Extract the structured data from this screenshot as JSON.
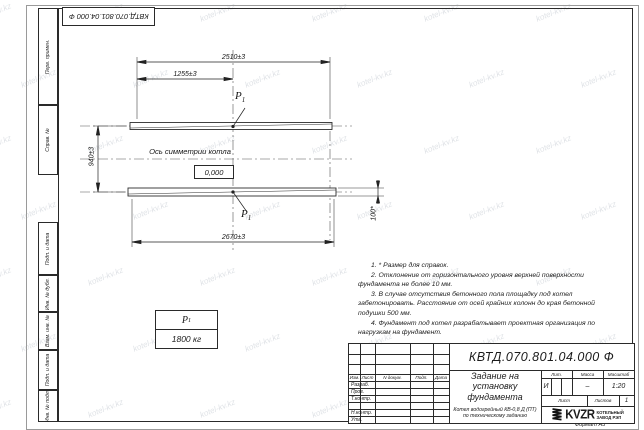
{
  "watermark": {
    "text": "kotel-kv.kz"
  },
  "doc_box": {
    "number": "КВТД.070.801.04.000 Ф"
  },
  "stamp_column": {
    "items": [
      "Перв. примен.",
      "Справ. №",
      "Подп. и дата",
      "Инв. № дубл.",
      "Взам. инв. №",
      "Подп. и дата",
      "Инв. № подл."
    ]
  },
  "drawing": {
    "dims": {
      "top": "2510±3",
      "half": "1255±3",
      "vertical": "940±3",
      "bottom": "2670±3",
      "height": "100*"
    },
    "axis_label": "Ось симметрии котла",
    "level_mark": "0,000",
    "load_label": {
      "base": "P",
      "sub": "1"
    },
    "load_table": {
      "header_base": "P",
      "header_sub": "1",
      "value": "1800 кг"
    }
  },
  "notes": [
    "1. * Размер для справок.",
    "2. Отклонение от горизонтального уровня верхней поверхности фундамента не более 10 мм.",
    "3. В случае отсутствия бетонного пола площадку под котел забетонировать. Расстояние от осей крайних колонн до края бетонной подушки 500 мм.",
    "4. Фундамент под котел разрабатывает проектная организация по нагрузкам на фундамент."
  ],
  "title_block": {
    "doc_number": "КВТД.070.801.04.000 Ф",
    "title": "Задание на установку фундамента",
    "subject": "Котел водогрейный КВ-0,8 Д (ПТ) по техническому заданию",
    "header_cols": [
      "Изм.",
      "Лист",
      "N докум.",
      "Подп.",
      "Дата"
    ],
    "rows": [
      "Разраб.",
      "Пров.",
      "Т.контр.",
      "",
      "Н.контр.",
      "Утв."
    ],
    "lit_label": "Лит.",
    "mass_label": "Масса",
    "scale_label": "Масштаб",
    "lit_value": "И",
    "mass_value": "–",
    "scale_value": "1:20",
    "sheet_label": "Лист",
    "sheets_label": "Листов",
    "sheets_value": "1",
    "logo_text": "KVZR",
    "logo_caption_1": "КОТЕЛЬНЫЙ",
    "logo_caption_2": "ЗАВОД РЭП"
  },
  "footer": {
    "format_label": "Формат А3"
  }
}
